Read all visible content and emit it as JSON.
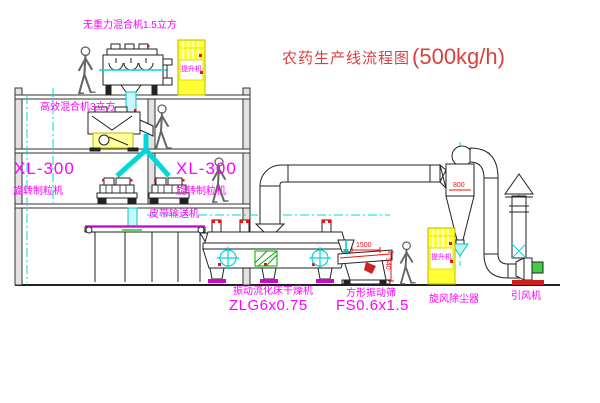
{
  "title": {
    "name_cn": "农药生产线流程图",
    "capacity": "(500kg/h)"
  },
  "equipment_labels": {
    "top_mixer": "无重力混合机1.5立方",
    "second_mixer": "高效混合机3立方",
    "granulator_left_model": "XL-300",
    "granulator_left_name": "旋转制粒机",
    "granulator_right_model": "XL-300",
    "granulator_right_name": "旋转制粒机",
    "belt_conveyor": "皮带输送机",
    "dryer_name": "振动流化床干燥机",
    "dryer_model": "ZLG6x0.75",
    "sieve_name": "方形振动筛",
    "sieve_model": "FS0.6x1.5",
    "cyclone_name": "旋风除尘器",
    "fan_name": "引风机",
    "elevator_cabinet_text": "提升机"
  },
  "dimensions": {
    "cyclone_width": "800",
    "sieve_length": "1500",
    "sieve_height": "540"
  },
  "colors": {
    "label_magenta": "#ff00ff",
    "title_red": "#d84040",
    "dimension_red": "#ee1111",
    "centerline_cyan": "#00d8d8",
    "equipment_yellow": "#ffff33",
    "motor_green": "#44cc44",
    "line_dark": "#2a2a2a"
  }
}
